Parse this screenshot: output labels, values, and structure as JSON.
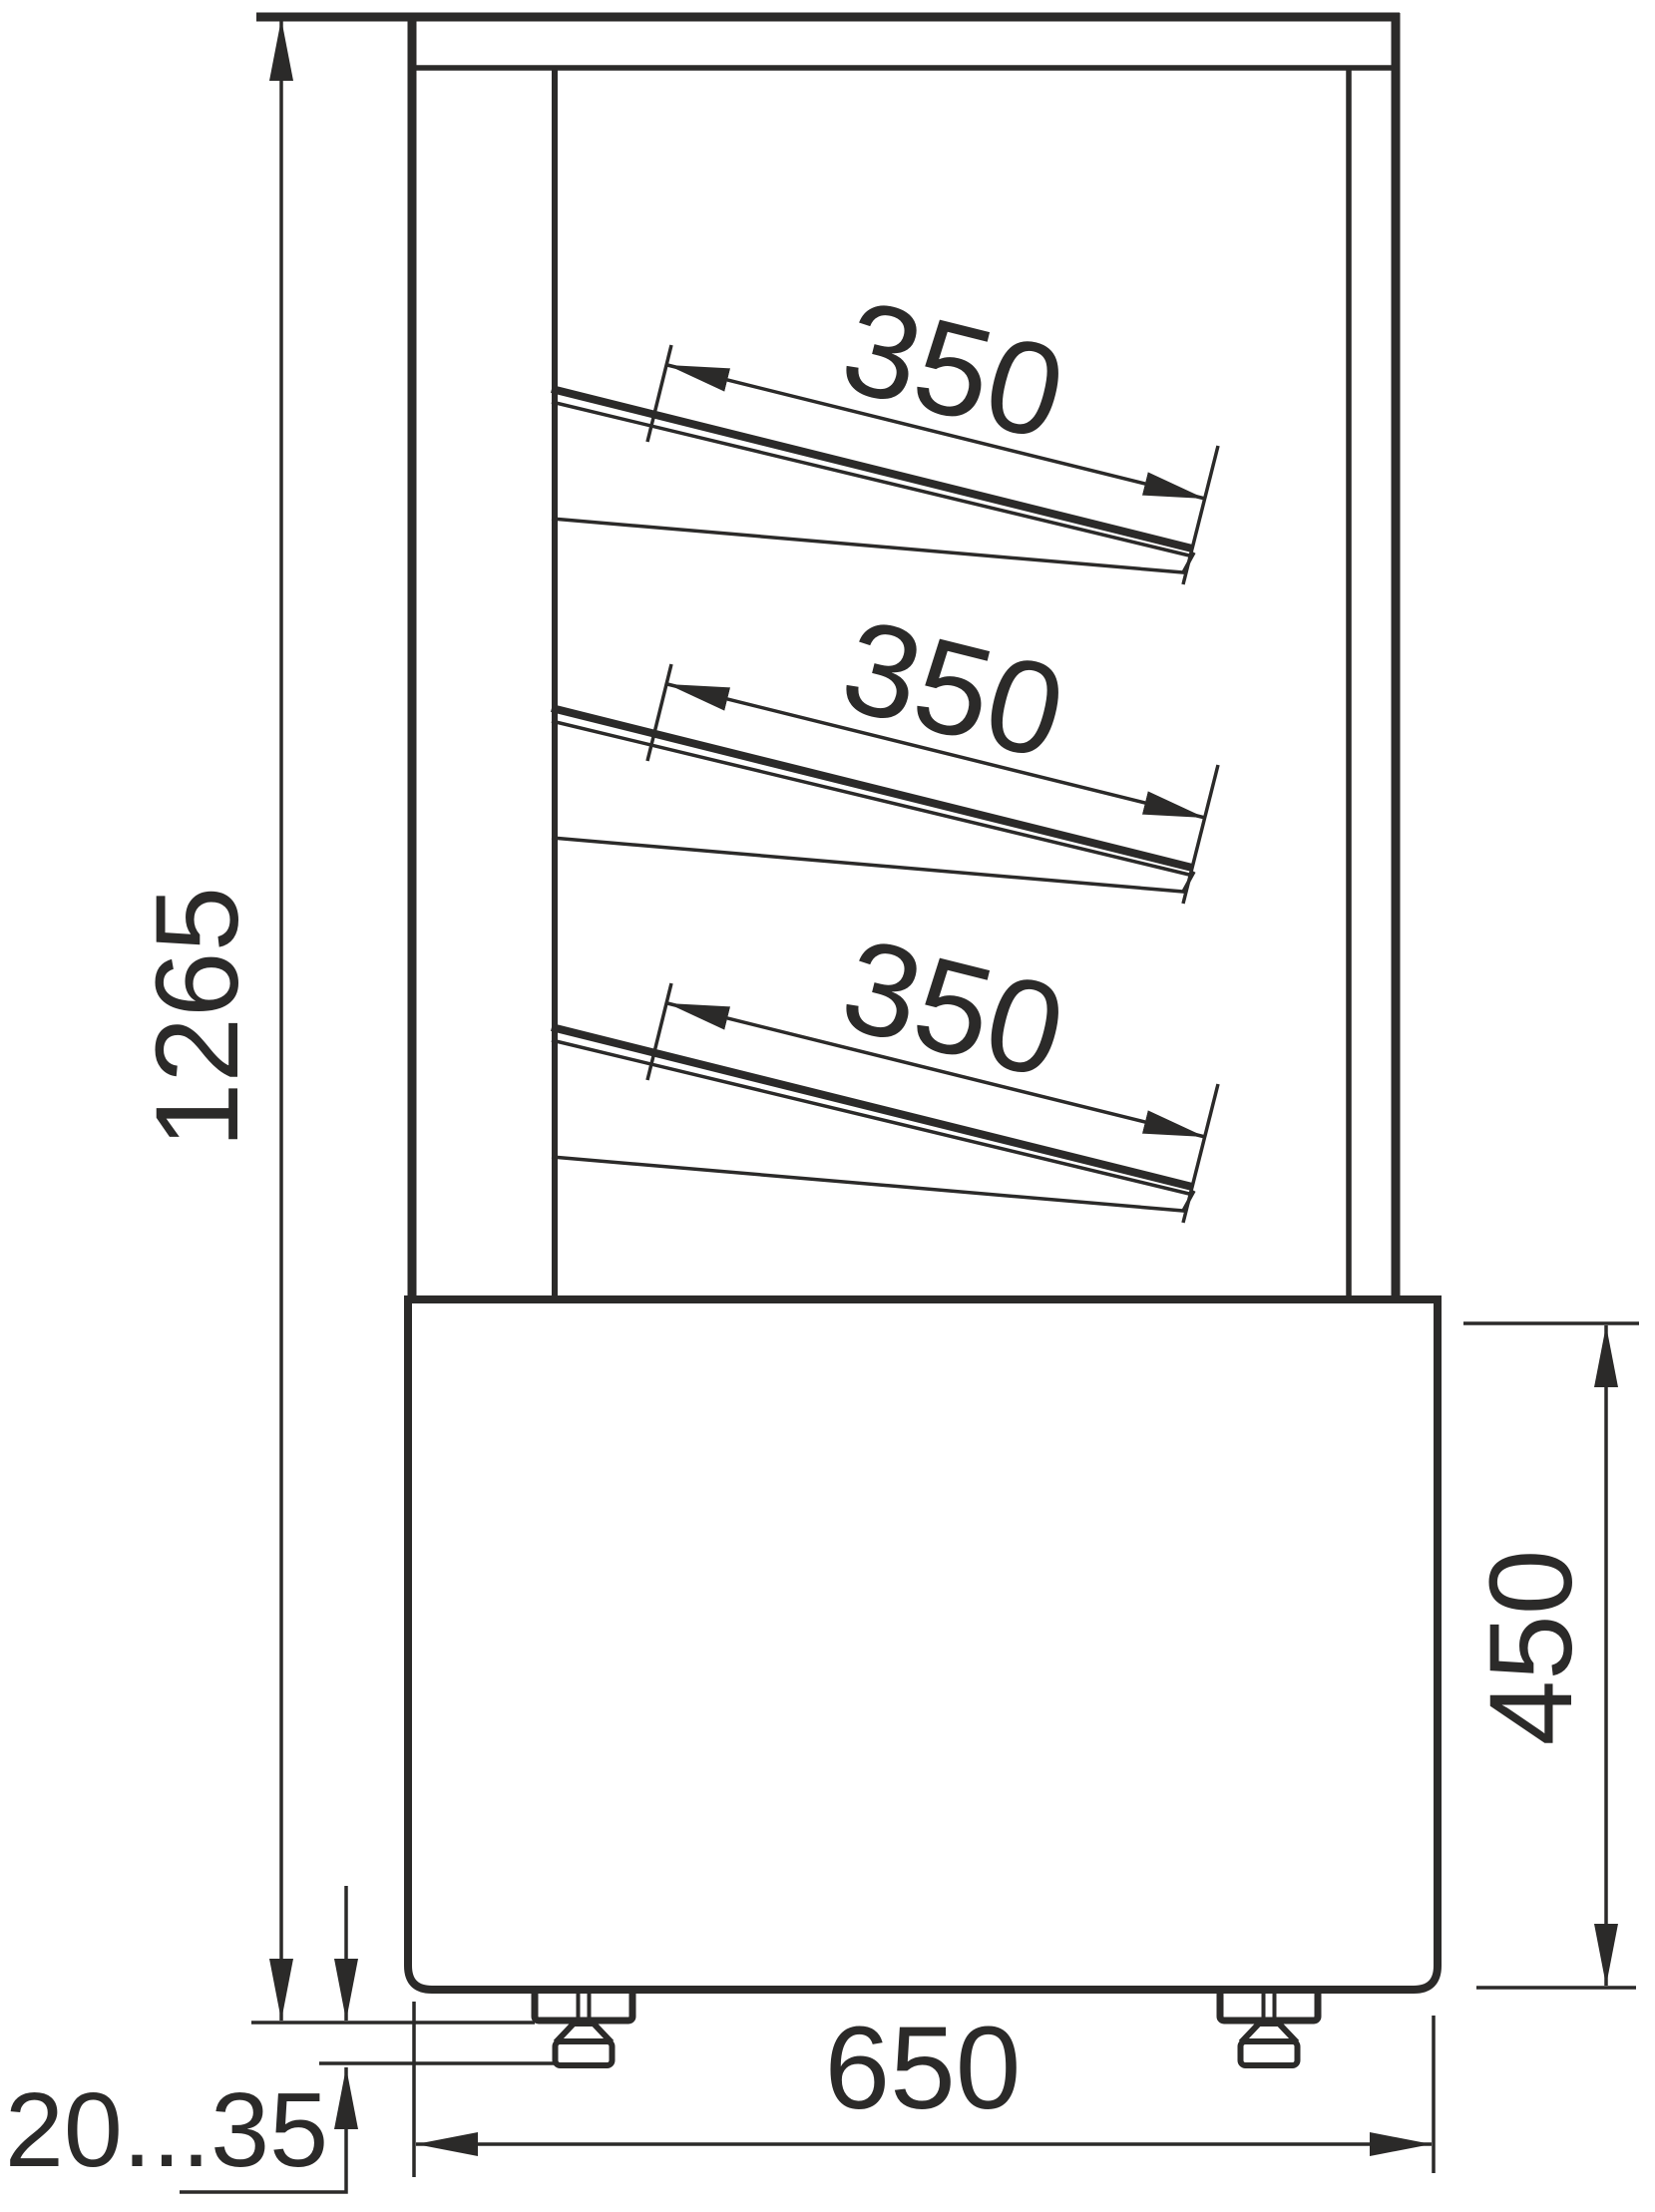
{
  "drawing": {
    "type": "technical-dimension-drawing",
    "subject": "refrigerated display case - side section view",
    "units": "mm",
    "colors": {
      "line": "#2b2a29",
      "background": "#ffffff"
    },
    "dimensions": {
      "overall_height": "1265",
      "base_height": "450",
      "base_depth": "650",
      "foot_adjustment": "20...35",
      "shelves": [
        {
          "label": "350"
        },
        {
          "label": "350"
        },
        {
          "label": "350"
        }
      ]
    }
  }
}
